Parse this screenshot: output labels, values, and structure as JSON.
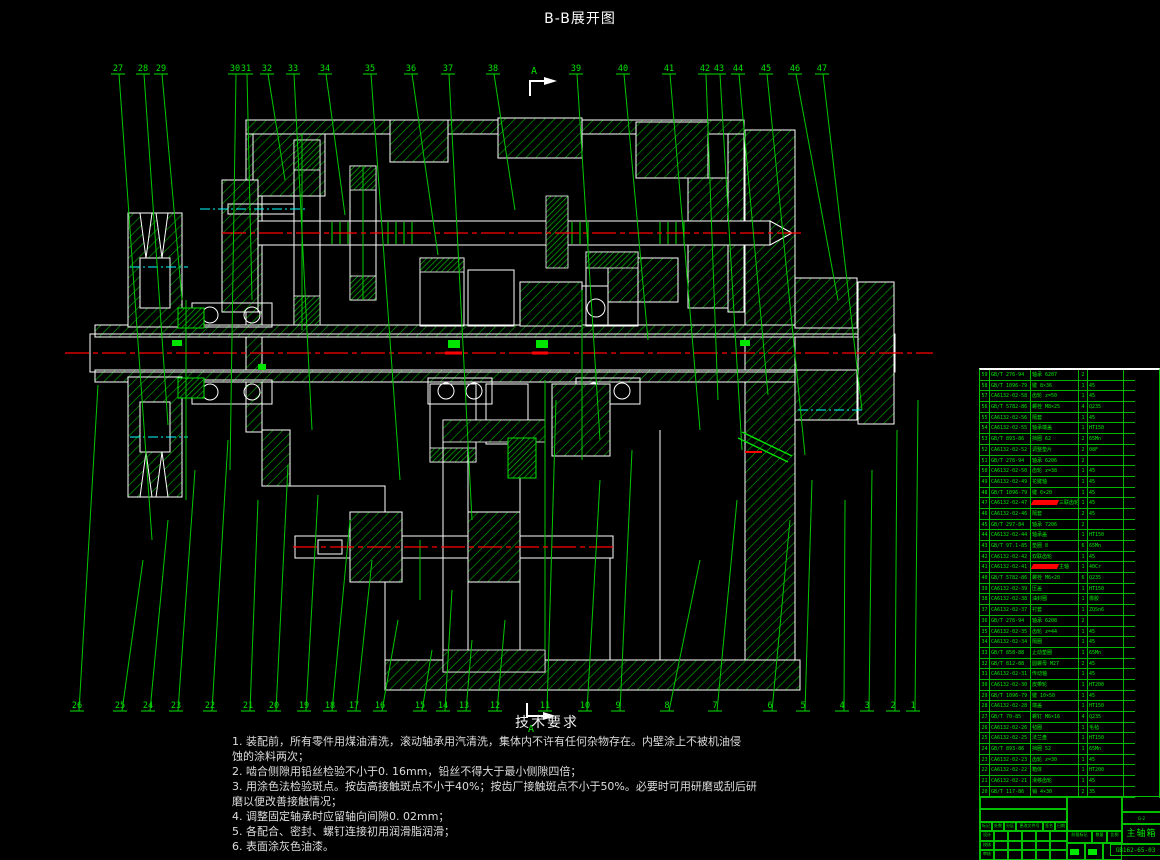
{
  "title": "B-B展开图",
  "colors": {
    "background": "#000000",
    "cad_green": "#00e400",
    "cad_white": "#ffffff",
    "centerline_red": "#ff0000",
    "aux_cyan": "#00ffff",
    "highlight_red": "#ff0000"
  },
  "section_marker": {
    "label": "A"
  },
  "tech_requirements": {
    "heading": "技术要求",
    "lines": [
      "1. 装配前，所有零件用煤油清洗，滚动轴承用汽清洗，集体内不许有任何杂物存在。内壁涂上不被机油侵",
      "蚀的涂料两次；",
      "2. 啮合侧隙用铅丝检验不小于0. 16mm，铅丝不得大于最小侧隙四倍；",
      "3. 用涂色法检验斑点。按齿高接触斑点不小于40%；按齿厂接触斑点不小于50%。必要时可用研磨或刮后研",
      "磨以便改善接触情况；",
      "4. 调整固定轴承时应留轴向间隙0. 02mm；",
      "5. 各配合、密封、螺钉连接初用润滑脂润滑；",
      "6. 表面涂灰色油漆。"
    ]
  },
  "callouts": {
    "top": [
      {
        "n": "27",
        "x": 118,
        "tx": 152,
        "ty": 540
      },
      {
        "n": "28",
        "x": 143,
        "tx": 168,
        "ty": 425
      },
      {
        "n": "29",
        "x": 161,
        "tx": 182,
        "ty": 300
      },
      {
        "n": "30",
        "x": 235,
        "tx": 230,
        "ty": 470
      },
      {
        "n": "31",
        "x": 246,
        "tx": 252,
        "ty": 300
      },
      {
        "n": "32",
        "x": 267,
        "tx": 285,
        "ty": 180
      },
      {
        "n": "33",
        "x": 293,
        "tx": 312,
        "ty": 430
      },
      {
        "n": "34",
        "x": 325,
        "tx": 345,
        "ty": 215
      },
      {
        "n": "35",
        "x": 370,
        "tx": 400,
        "ty": 480
      },
      {
        "n": "36",
        "x": 411,
        "tx": 438,
        "ty": 255
      },
      {
        "n": "37",
        "x": 448,
        "tx": 472,
        "ty": 520
      },
      {
        "n": "38",
        "x": 493,
        "tx": 515,
        "ty": 210
      },
      {
        "n": "39",
        "x": 576,
        "tx": 600,
        "ty": 440
      },
      {
        "n": "40",
        "x": 623,
        "tx": 648,
        "ty": 340
      },
      {
        "n": "41",
        "x": 669,
        "tx": 700,
        "ty": 430
      },
      {
        "n": "42",
        "x": 705,
        "tx": 718,
        "ty": 400
      },
      {
        "n": "43",
        "x": 719,
        "tx": 742,
        "ty": 450
      },
      {
        "n": "44",
        "x": 738,
        "tx": 768,
        "ty": 395
      },
      {
        "n": "45",
        "x": 766,
        "tx": 805,
        "ty": 455
      },
      {
        "n": "46",
        "x": 795,
        "tx": 838,
        "ty": 300
      },
      {
        "n": "47",
        "x": 822,
        "tx": 862,
        "ty": 410
      }
    ],
    "bottom": [
      {
        "n": "26",
        "x": 77,
        "tx": 98,
        "ty": 385
      },
      {
        "n": "25",
        "x": 120,
        "tx": 143,
        "ty": 560
      },
      {
        "n": "24",
        "x": 148,
        "tx": 168,
        "ty": 520
      },
      {
        "n": "23",
        "x": 176,
        "tx": 195,
        "ty": 470
      },
      {
        "n": "22",
        "x": 210,
        "tx": 228,
        "ty": 440
      },
      {
        "n": "21",
        "x": 248,
        "tx": 258,
        "ty": 500
      },
      {
        "n": "20",
        "x": 274,
        "tx": 288,
        "ty": 465
      },
      {
        "n": "19",
        "x": 304,
        "tx": 318,
        "ty": 495
      },
      {
        "n": "18",
        "x": 330,
        "tx": 350,
        "ty": 520
      },
      {
        "n": "17",
        "x": 354,
        "tx": 372,
        "ty": 560
      },
      {
        "n": "16",
        "x": 380,
        "tx": 398,
        "ty": 620
      },
      {
        "n": "15",
        "x": 420,
        "tx": 432,
        "ty": 650
      },
      {
        "n": "14",
        "x": 443,
        "tx": 452,
        "ty": 590
      },
      {
        "n": "13",
        "x": 464,
        "tx": 472,
        "ty": 640
      },
      {
        "n": "12",
        "x": 495,
        "tx": 505,
        "ty": 620
      },
      {
        "n": "11",
        "x": 545,
        "tx": 556,
        "ty": 400
      },
      {
        "n": "10",
        "x": 585,
        "tx": 600,
        "ty": 480
      },
      {
        "n": "9",
        "x": 618,
        "tx": 632,
        "ty": 450
      },
      {
        "n": "8",
        "x": 667,
        "tx": 700,
        "ty": 560
      },
      {
        "n": "7",
        "x": 715,
        "tx": 737,
        "ty": 500
      },
      {
        "n": "6",
        "x": 770,
        "tx": 790,
        "ty": 520
      },
      {
        "n": "5",
        "x": 803,
        "tx": 812,
        "ty": 480
      },
      {
        "n": "4",
        "x": 842,
        "tx": 845,
        "ty": 500
      },
      {
        "n": "3",
        "x": 867,
        "tx": 872,
        "ty": 470
      },
      {
        "n": "2",
        "x": 893,
        "tx": 897,
        "ty": 430
      },
      {
        "n": "1",
        "x": 913,
        "tx": 918,
        "ty": 400
      }
    ]
  },
  "parts_table": {
    "rows": [
      [
        "59",
        "GB/T 276-94",
        "轴承 6207",
        "2",
        "",
        ""
      ],
      [
        "58",
        "GB/T 1096-79",
        "键 8×36",
        "1",
        "45",
        ""
      ],
      [
        "57",
        "CA6132-02-58",
        "齿轮 z=50",
        "1",
        "45",
        ""
      ],
      [
        "56",
        "GB/T 5782-86",
        "螺栓 M8×25",
        "4",
        "Q235",
        ""
      ],
      [
        "55",
        "CA6132-02-56",
        "隔套",
        "1",
        "45",
        ""
      ],
      [
        "54",
        "CA6132-02-55",
        "轴承端盖",
        "1",
        "HT150",
        ""
      ],
      [
        "53",
        "GB/T 893-86",
        "挡圈 62",
        "2",
        "65Mn",
        ""
      ],
      [
        "52",
        "CA6132-02-52",
        "调整垫片",
        "2",
        "08F",
        ""
      ],
      [
        "51",
        "GB/T 276-94",
        "轴承 6206",
        "2",
        "",
        ""
      ],
      [
        "50",
        "CA6132-02-50",
        "齿轮 z=38",
        "1",
        "45",
        ""
      ],
      [
        "49",
        "CA6132-02-49",
        "花键轴",
        "1",
        "45",
        ""
      ],
      [
        "48",
        "GB/T 1096-79",
        "键 6×20",
        "1",
        "45",
        ""
      ],
      [
        "47",
        "CA6132-02-47",
        "三联齿轮",
        "1",
        "45",
        ""
      ],
      [
        "46",
        "CA6132-02-46",
        "隔套",
        "2",
        "45",
        ""
      ],
      [
        "45",
        "GB/T 297-84",
        "轴承 7206",
        "2",
        "",
        ""
      ],
      [
        "44",
        "CA6132-02-44",
        "轴承盖",
        "1",
        "HT150",
        ""
      ],
      [
        "43",
        "GB/T 97.1-85",
        "垫圈 8",
        "6",
        "65Mn",
        ""
      ],
      [
        "42",
        "CA6132-02-42",
        "双联齿轮",
        "1",
        "45",
        ""
      ],
      [
        "41",
        "CA6132-02-41",
        "主轴",
        "1",
        "40Cr",
        ""
      ],
      [
        "40",
        "GB/T 5782-86",
        "螺栓 M6×20",
        "6",
        "Q235",
        ""
      ],
      [
        "39",
        "CA6132-02-39",
        "压盖",
        "1",
        "HT150",
        ""
      ],
      [
        "38",
        "CA6132-02-38",
        "油封圈",
        "1",
        "橡胶",
        ""
      ],
      [
        "37",
        "CA6132-02-37",
        "衬套",
        "1",
        "ZQSn6",
        ""
      ],
      [
        "36",
        "GB/T 276-94",
        "轴承 6208",
        "2",
        "",
        ""
      ],
      [
        "35",
        "CA6132-02-35",
        "齿轮 z=44",
        "1",
        "45",
        ""
      ],
      [
        "34",
        "CA6132-02-34",
        "隔圈",
        "1",
        "45",
        ""
      ],
      [
        "33",
        "GB/T 858-88",
        "止动垫圈",
        "1",
        "65Mn",
        ""
      ],
      [
        "32",
        "GB/T 812-88",
        "圆螺母 M27",
        "2",
        "45",
        ""
      ],
      [
        "31",
        "CA6132-02-31",
        "传动轴",
        "1",
        "45",
        ""
      ],
      [
        "30",
        "CA6132-02-30",
        "皮带轮",
        "1",
        "HT200",
        ""
      ],
      [
        "29",
        "GB/T 1096-79",
        "键 10×50",
        "1",
        "45",
        ""
      ],
      [
        "28",
        "CA6132-02-28",
        "端盖",
        "1",
        "HT150",
        ""
      ],
      [
        "27",
        "GB/T 70-85",
        "螺钉 M6×16",
        "4",
        "Q235",
        ""
      ],
      [
        "26",
        "CA6132-02-26",
        "毡圈",
        "1",
        "毛毡",
        ""
      ],
      [
        "25",
        "CA6132-02-25",
        "法兰盘",
        "1",
        "HT150",
        ""
      ],
      [
        "24",
        "GB/T 893-86",
        "挡圈 52",
        "1",
        "65Mn",
        ""
      ],
      [
        "23",
        "CA6132-02-23",
        "齿轮 z=30",
        "1",
        "45",
        ""
      ],
      [
        "22",
        "CA6132-02-22",
        "箱体",
        "1",
        "HT200",
        ""
      ],
      [
        "21",
        "CA6132-02-21",
        "滑移齿轮",
        "1",
        "45",
        ""
      ],
      [
        "20",
        "GB/T 117-86",
        "销 4×30",
        "2",
        "35",
        ""
      ]
    ],
    "red_row_indices": [
      12,
      18
    ]
  },
  "title_block": {
    "product": "主轴箱",
    "drawing_no": "GB162-65-03",
    "change_labels": [
      "标记",
      "处数",
      "分区",
      "更改文件号",
      "签名",
      "日期"
    ],
    "sign_labels": [
      "设计",
      "校核",
      "审核",
      "工艺",
      "批准"
    ],
    "stage_labels": [
      "阶段标记",
      "数量",
      "比例"
    ]
  }
}
